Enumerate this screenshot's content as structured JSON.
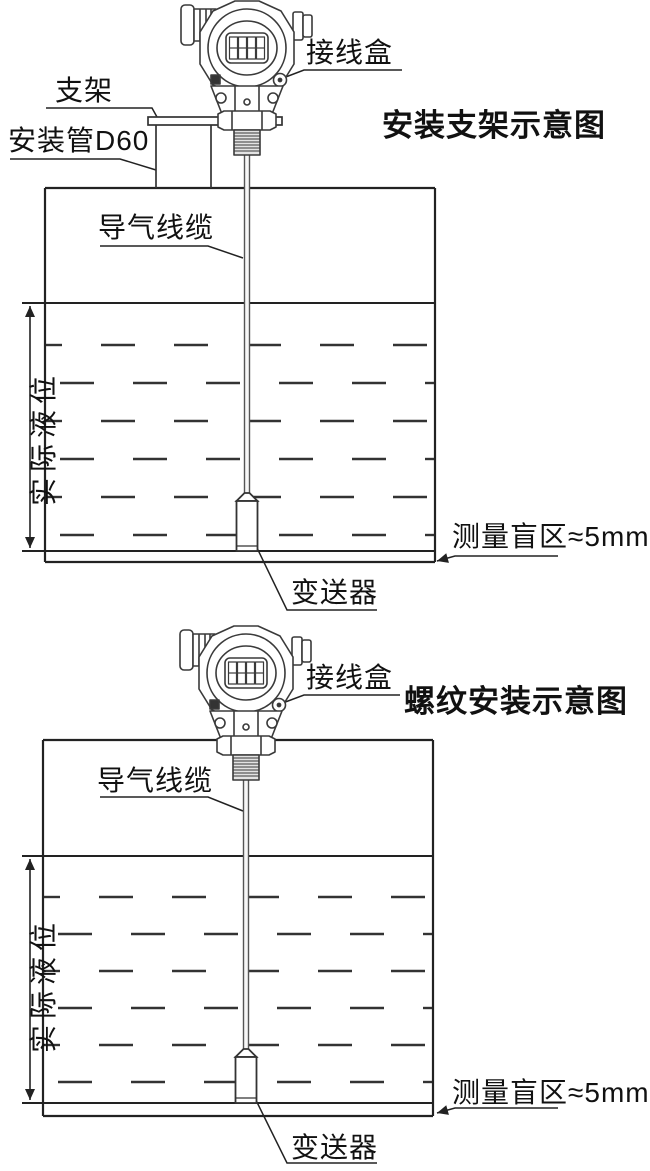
{
  "page": {
    "background": "#ffffff"
  },
  "diagram1": {
    "title": "安装支架示意图",
    "labels": {
      "junction_box": "接线盒",
      "bracket": "支架",
      "mounting_pipe": "安装管D60",
      "air_cable": "导气线缆",
      "actual_level": "实际液位",
      "blind_zone": "测量盲区≈5mm",
      "transmitter": "变送器"
    }
  },
  "diagram2": {
    "title": "螺纹安装示意图",
    "labels": {
      "junction_box": "接线盒",
      "air_cable": "导气线缆",
      "actual_level": "实际液位",
      "blind_zone": "测量盲区≈5mm",
      "transmitter": "变送器"
    }
  },
  "colors": {
    "line": "#333333",
    "text": "#111111",
    "thread_fill": "#e3e3e3",
    "cable_fill": "#f7f7f7"
  }
}
